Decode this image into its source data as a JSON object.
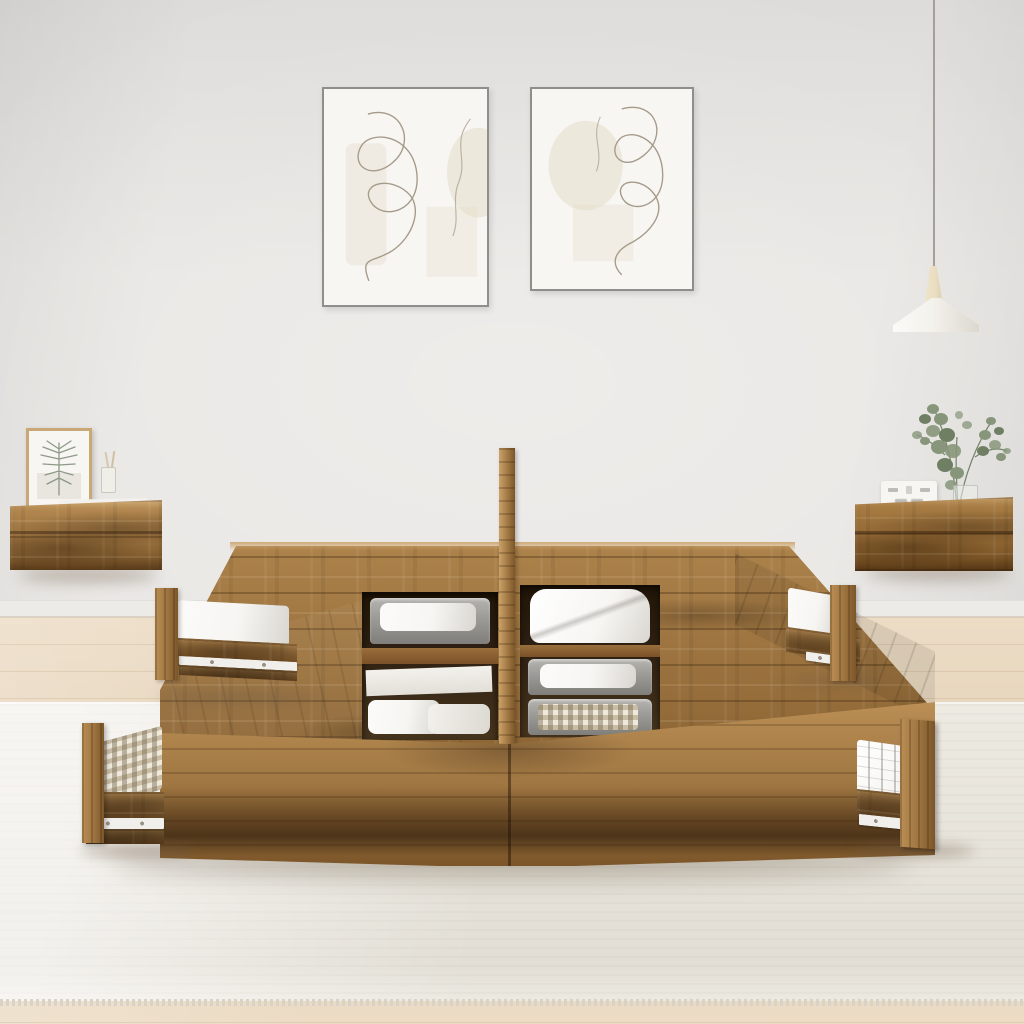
{
  "scene": {
    "description": "Bright bedroom product photo: rustic reclaimed-wood storage bed frame with four pulled-out drawers and open top compartments holding felt baskets, folded towels and blankets; two floating wood nightstands on the wall, two framed abstract line-art prints, and a white pendant lamp",
    "wall_art": {
      "count": 2,
      "style": "abstract one-line drawings with beige shapes"
    },
    "pendant_lamp": {
      "shade": "flared white cone",
      "socket": "cream wood cone"
    },
    "nightstand_left": {
      "items": [
        "framed botanical sketch",
        "stack of two white books",
        "glass reed diffuser"
      ]
    },
    "nightstand_right": {
      "items": [
        "white flip clock with illegible faint digits",
        "glass vase with eucalyptus branches"
      ]
    },
    "bed": {
      "material": "rustic pine-look wood",
      "drawers_open": 4,
      "compartments": [
        [
          "felt basket with white towel",
          "white storage box",
          "folded white towels"
        ],
        [
          "folded white duvet",
          "felt basket with white towel",
          "felt basket with checkered blanket"
        ]
      ],
      "drawer_contents": [
        "white folded linen",
        "white folded linen",
        "beige gingham blanket",
        "white stitched fabric"
      ]
    },
    "floor": "light oak laminate",
    "rug": "cream flat-weave rug with fringe edge"
  },
  "colors": {
    "wall_top": "#dddbd9",
    "wall_main": "#e8e6e3",
    "baseboard": "#edebe7",
    "floor_light": "#ecdcc5",
    "floor_dark": "#e3d0b6",
    "rug": "#edeae2",
    "rug_shade": "#e2ded5",
    "rug_fringe": "#d8d3c6",
    "wood_light": "#bb8f55",
    "wood_mid": "#9d7440",
    "wood_dark": "#7c5629",
    "wood_top_edge": "#cba268",
    "opening_dark": "#2e2012",
    "linen": "#f6f5f2",
    "linen_shadow": "#d9d6d0",
    "basket": "#9b9a96",
    "basket_dark": "#7f7e7a",
    "plaid_light": "#efe9dc",
    "plaid_dark": "#c9bda6",
    "rail_white": "#f1efec",
    "frame_gray": "#8f8e8b",
    "art_bg": "#f7f6f3",
    "art_shape": "#e6dcc9",
    "art_line": "#a69a89",
    "frame_wood": "#c9a878",
    "fern": "#7c8a74",
    "leaf": "#87967a",
    "leaf_dark": "#6f7f63",
    "stem": "#74836a",
    "glass": "#e8eae6",
    "clock": "#f7f6f3",
    "clock_mark": "#8f8d88",
    "lamp_shade": "#f4f2ec",
    "lamp_shade_dark": "#dcd8cf",
    "lamp_socket": "#e9ddc1",
    "cord": "#a3a09b",
    "shadow": "rgba(108,89,68,0.35)"
  }
}
